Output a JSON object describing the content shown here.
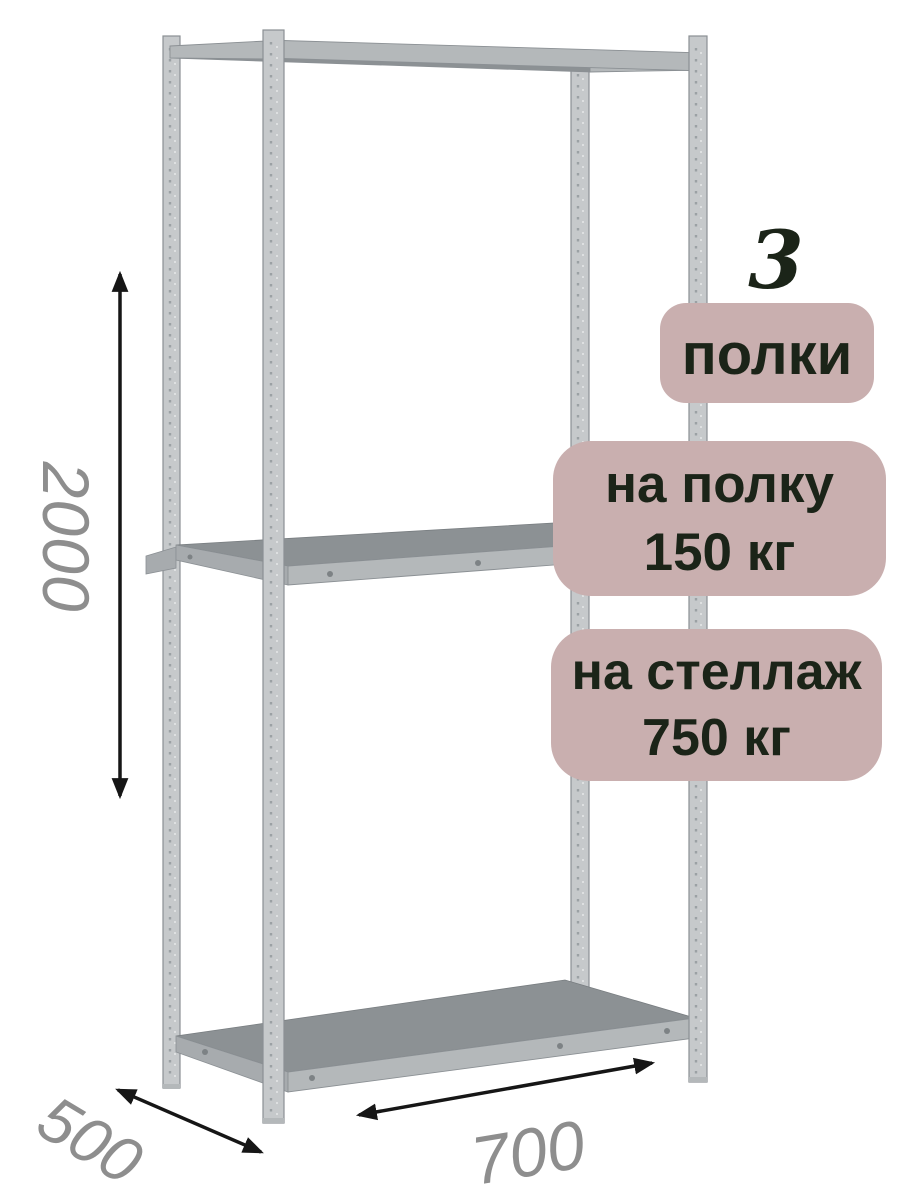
{
  "product_annotations": {
    "shelves_count": "3",
    "shelves_label": "полки",
    "shelf_load": {
      "line1": "на полку",
      "line2": "150 кг"
    },
    "rack_load": {
      "line1": "на стеллаж",
      "line2": "750 кг"
    }
  },
  "dimensions": {
    "height_mm": "2000",
    "depth_mm": "500",
    "width_mm": "700"
  },
  "colors": {
    "badge_bg": "#c9afaf",
    "badge_text": "#1b2418",
    "dim_text": "#8e8e8e",
    "arrow": "#161616",
    "metal_light": "#c6c9cb",
    "metal_mid": "#b4b8ba",
    "metal_dark": "#8c9194",
    "metal_edge": "#8b9094",
    "metal_hilite": "#e4e6e7",
    "metal_perf": "#9ba1a4"
  }
}
